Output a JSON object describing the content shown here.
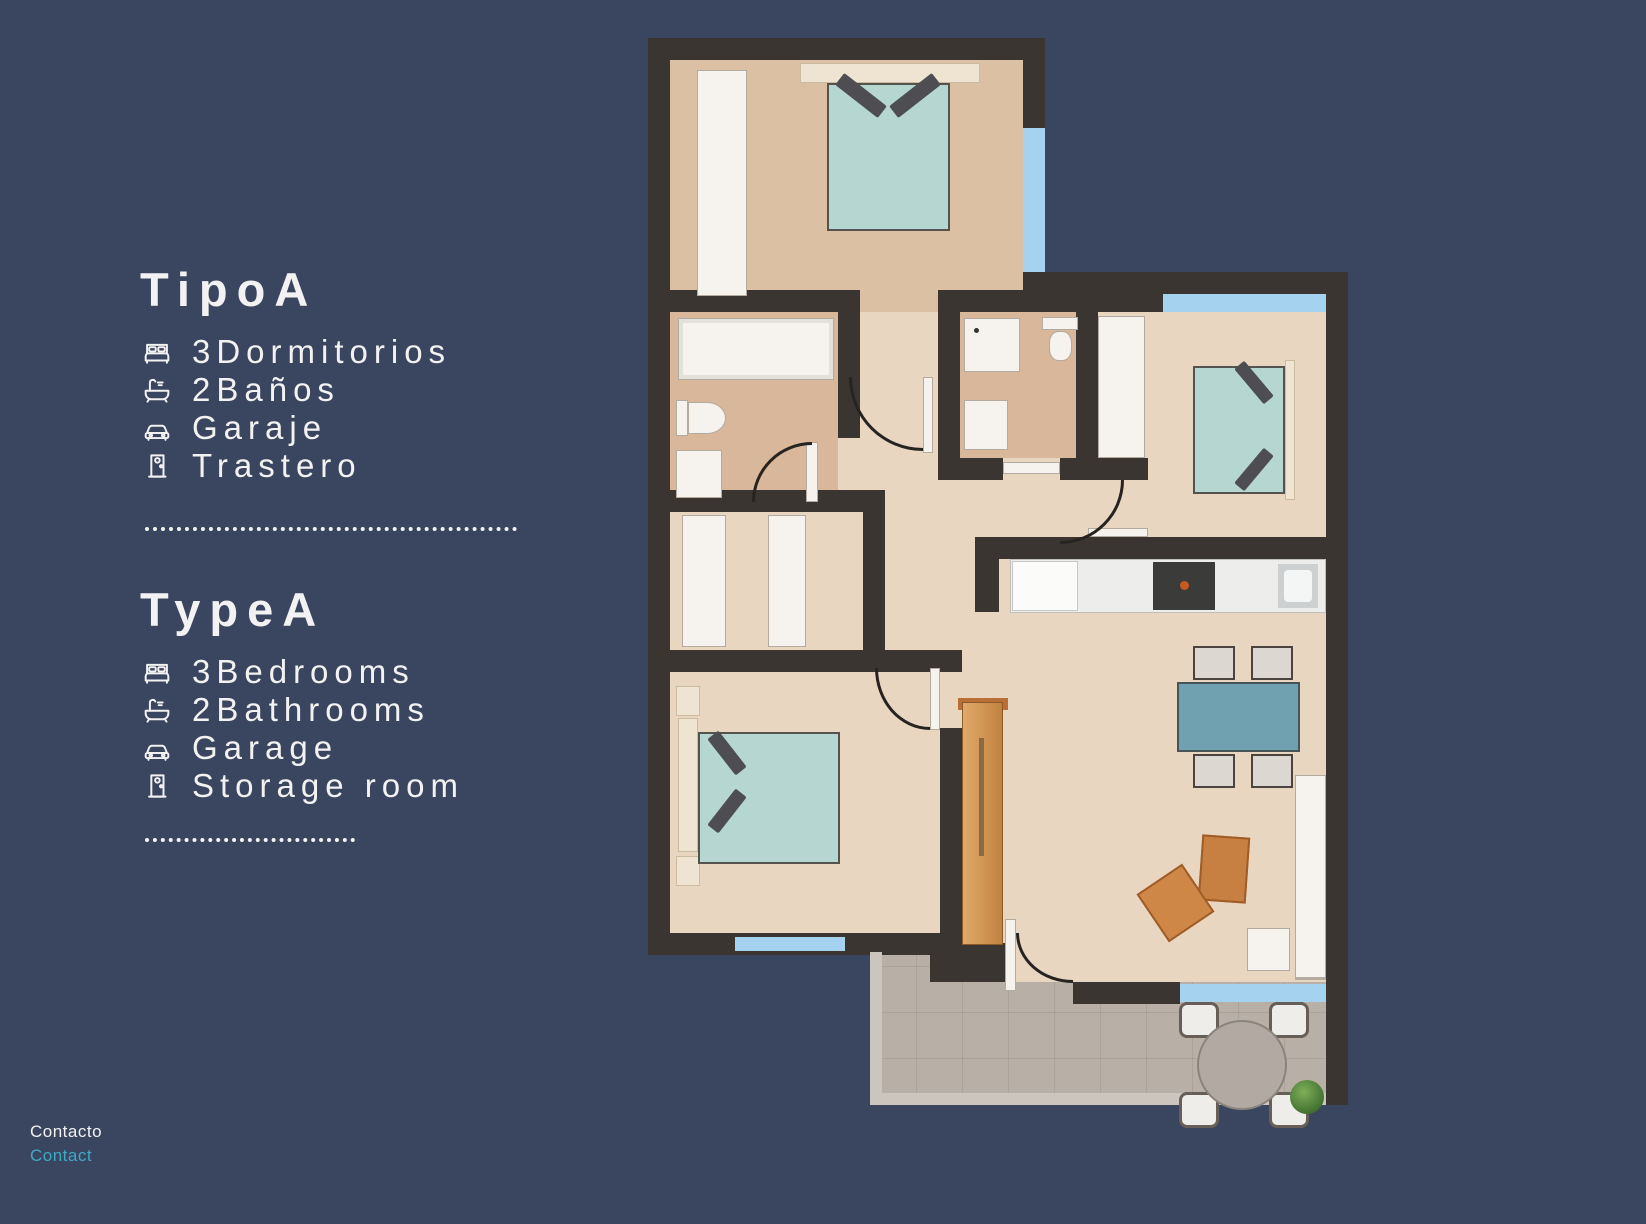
{
  "colors": {
    "background": "#3a4560",
    "text": "#f2f2f2",
    "link": "#3fa9c8",
    "wall": "#3a3531",
    "floor-warm": "#dcc0a4",
    "floor-light": "#e9d6c0",
    "floor-bath": "#d8b79a",
    "terrace": "#b8b0a7",
    "terrace-wall": "#ccc5bd",
    "window": "#a5d2ee",
    "bed": "#b5d6d1",
    "table": "#6fa1b1",
    "wood": "#d59f60",
    "orange": "#c87f42"
  },
  "panel_es": {
    "title": "TipoA",
    "items": [
      {
        "icon": "bed-icon",
        "label": "3Dormitorios"
      },
      {
        "icon": "bath-icon",
        "label": "2Baños"
      },
      {
        "icon": "car-icon",
        "label": "Garaje"
      },
      {
        "icon": "door-icon",
        "label": "Trastero"
      }
    ]
  },
  "panel_en": {
    "title": "TypeA",
    "items": [
      {
        "icon": "bed-icon",
        "label": "3Bedrooms"
      },
      {
        "icon": "bath-icon",
        "label": "2Bathrooms"
      },
      {
        "icon": "car-icon",
        "label": "Garage"
      },
      {
        "icon": "door-icon",
        "label": "Storage room"
      }
    ]
  },
  "footer": {
    "contact_es": "Contacto",
    "contact_en": "Contact"
  }
}
